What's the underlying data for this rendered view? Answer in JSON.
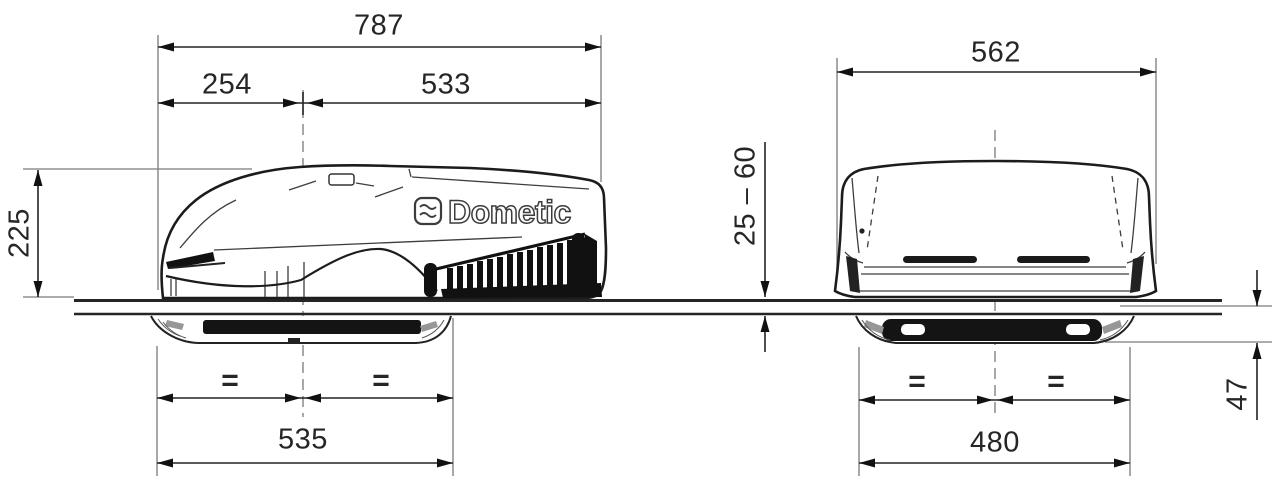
{
  "diagram": {
    "brand": "Dometic",
    "side_view": {
      "overall_length": "787",
      "front_section": "254",
      "rear_section": "533",
      "height": "225",
      "roof_opening_width": "535",
      "equal_left": "=",
      "equal_right": "="
    },
    "front_view": {
      "overall_width": "562",
      "roof_thickness_range": "25 – 60",
      "roof_opening_width": "480",
      "ceiling_unit_height": "47",
      "equal_left": "=",
      "equal_right": "="
    }
  }
}
